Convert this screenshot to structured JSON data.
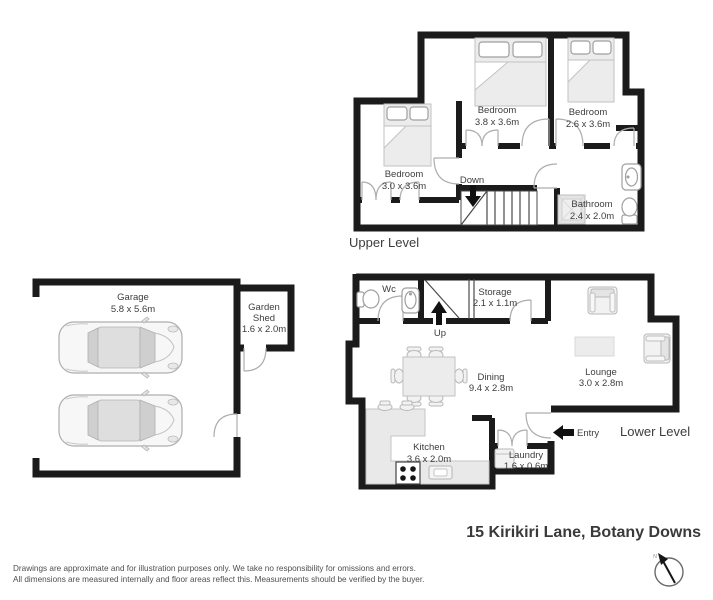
{
  "address": "15 Kirikiri Lane, Botany Downs",
  "upper_level": {
    "label": "Upper Level",
    "stairs_label": "Down",
    "rooms": {
      "bedroom_mid": {
        "name": "Bedroom",
        "dims": "3.8 x 3.6m"
      },
      "bedroom_right": {
        "name": "Bedroom",
        "dims": "2.6 x 3.6m"
      },
      "bedroom_left": {
        "name": "Bedroom",
        "dims": "3.0 x 3.6m"
      },
      "bathroom": {
        "name": "Bathroom",
        "dims": "2.4 x 2.0m"
      }
    }
  },
  "lower_level": {
    "label": "Lower Level",
    "stairs_label": "Up",
    "entry_label": "Entry",
    "rooms": {
      "wc": {
        "name": "Wc"
      },
      "storage": {
        "name": "Storage",
        "dims": "2.1 x 1.1m"
      },
      "dining": {
        "name": "Dining",
        "dims": "9.4 x 2.8m"
      },
      "lounge": {
        "name": "Lounge",
        "dims": "3.0 x 2.8m"
      },
      "kitchen": {
        "name": "Kitchen",
        "dims": "3.6 x 2.0m"
      },
      "laundry": {
        "name": "Laundry",
        "dims": "1.6 x 0.6m"
      }
    }
  },
  "garage_block": {
    "garage": {
      "name": "Garage",
      "dims": "5.8 x 5.6m"
    },
    "garden_shed": {
      "name_line1": "Garden",
      "name_line2": "Shed",
      "dims": "1.6 x 2.0m"
    }
  },
  "compass": {
    "north_label": "N"
  },
  "footer": {
    "disclaimer_line1": "Drawings are approximate and for illustration purposes only. We take no responsibility for omissions and errors.",
    "disclaimer_line2": "All dimensions are measured internally and floor areas reflect this. Measurements should be verified by the buyer."
  },
  "colors": {
    "wall": "#1b1b1b",
    "furniture": "#ececec",
    "door_arc": "#adadad",
    "text": "#3d3d3d"
  }
}
